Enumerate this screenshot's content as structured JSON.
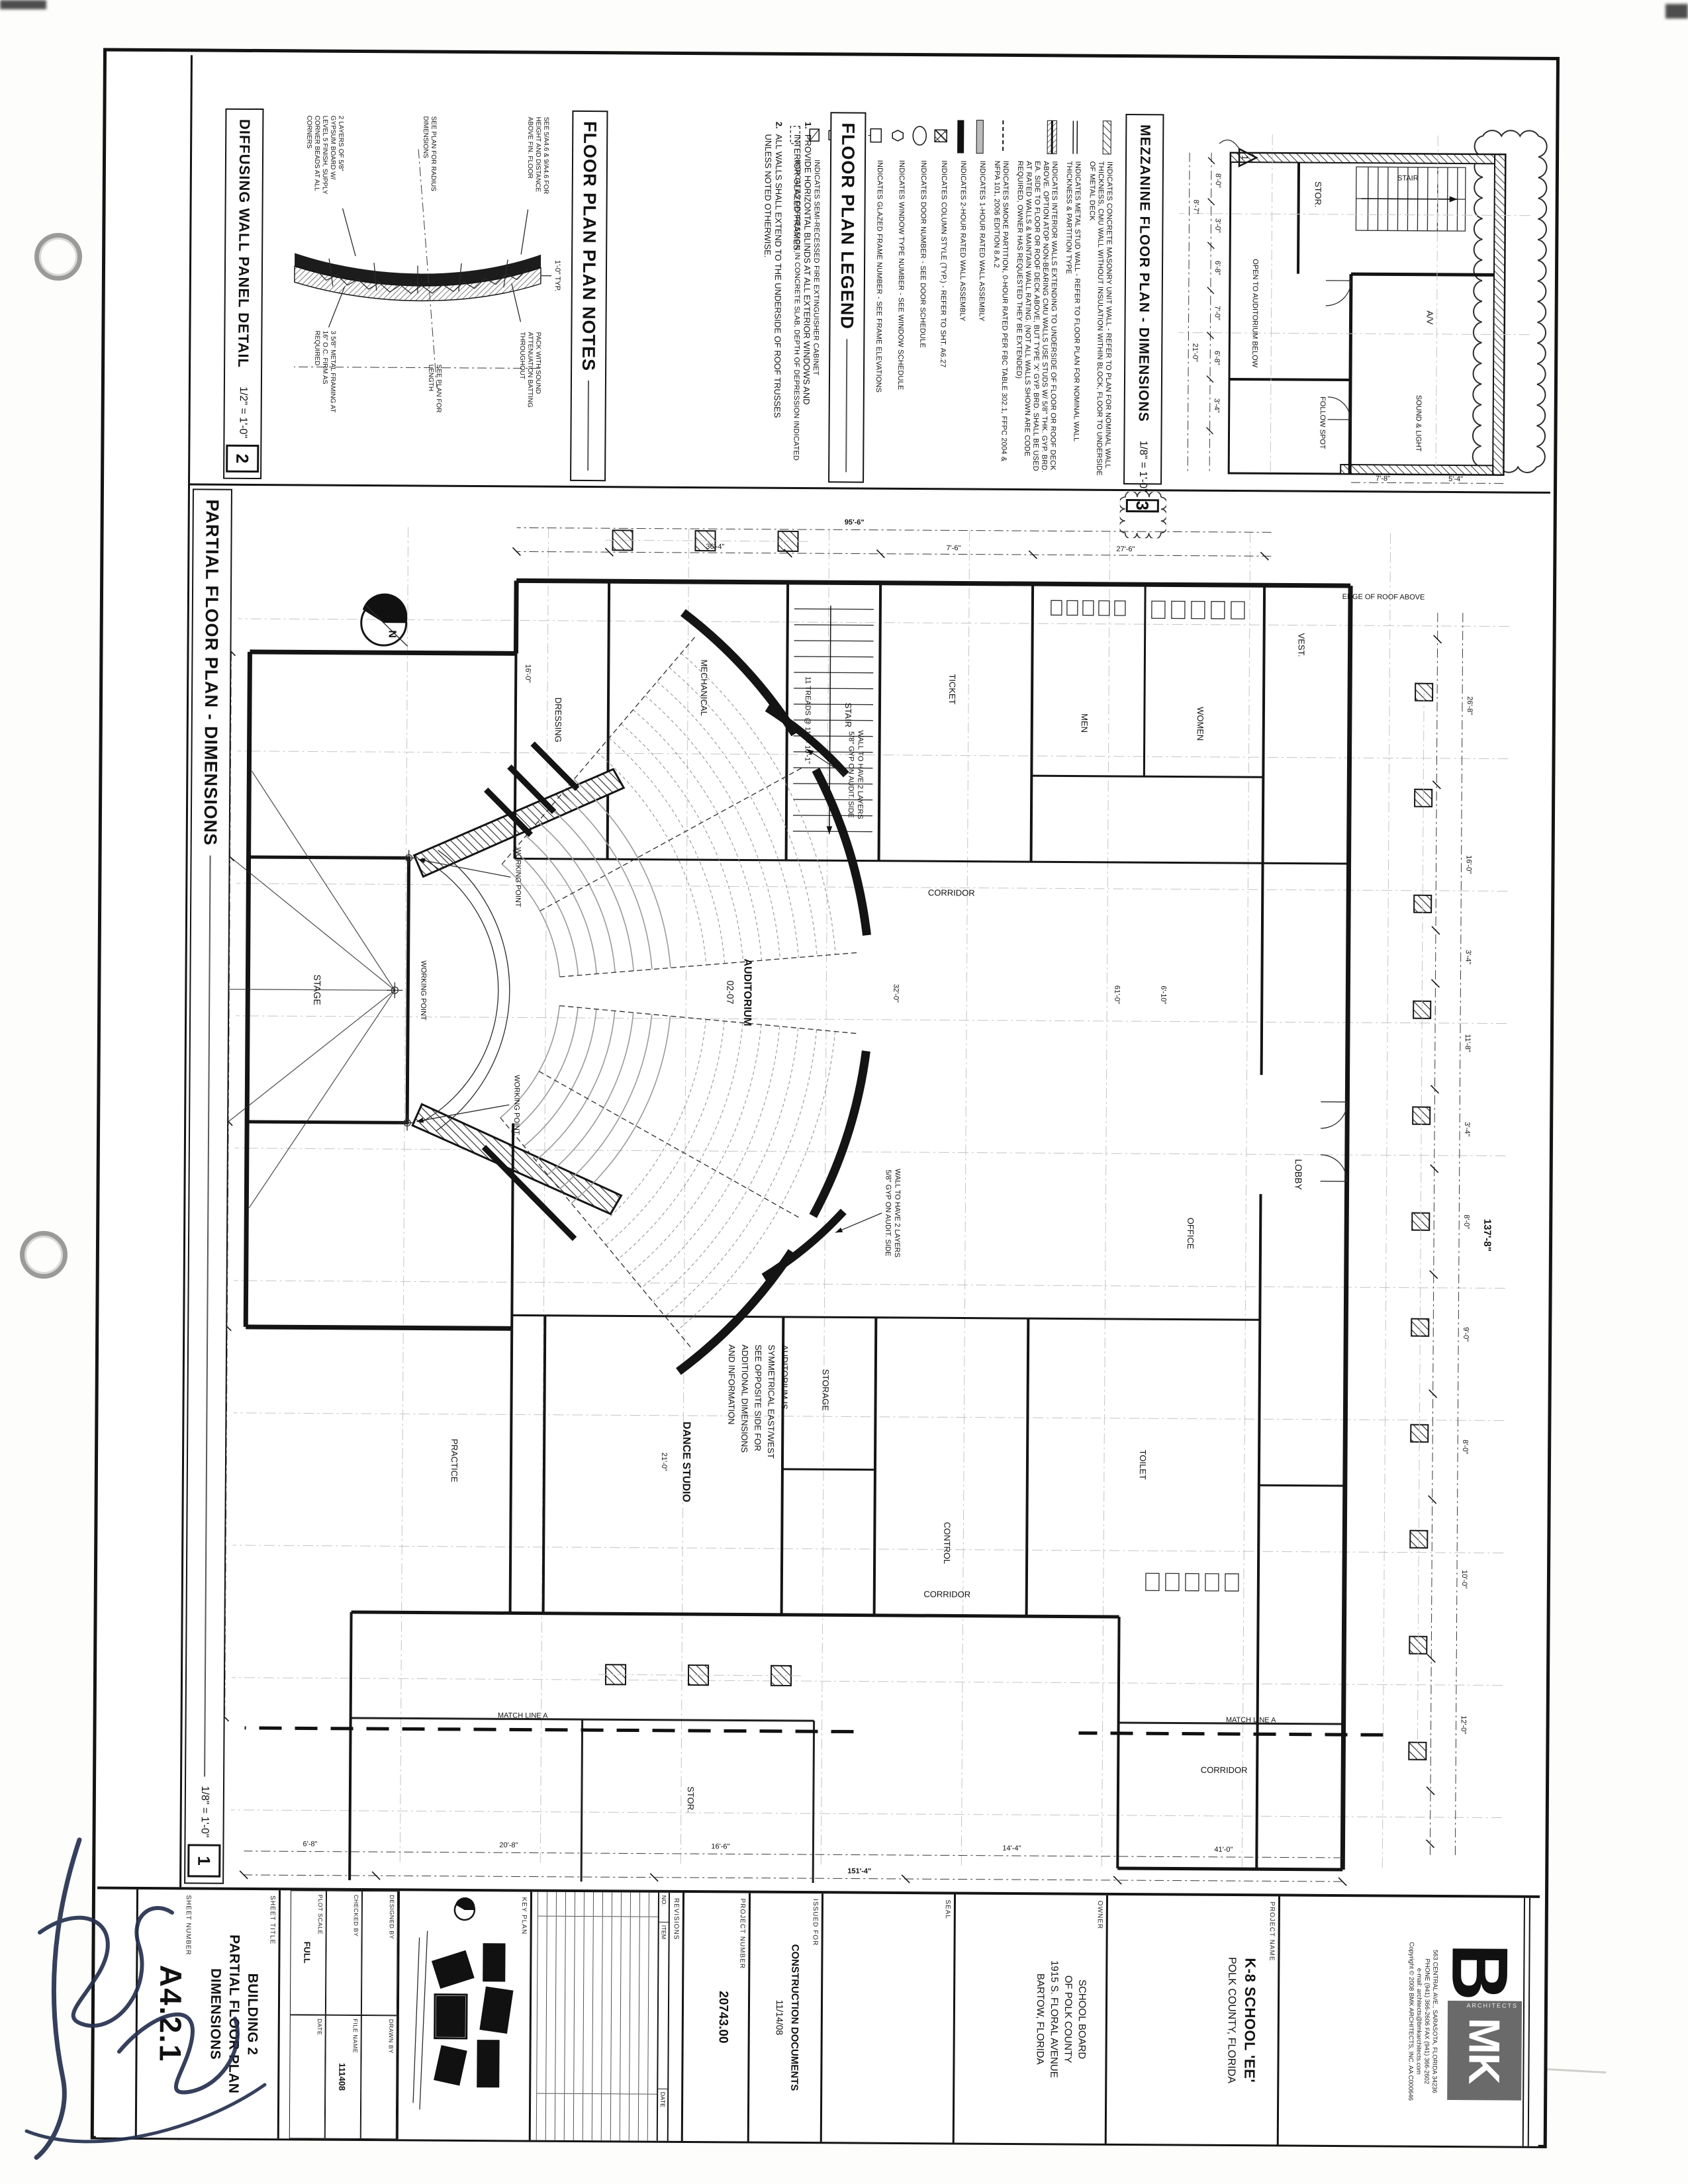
{
  "bars": {
    "plan": {
      "title": "PARTIAL FLOOR PLAN - DIMENSIONS",
      "scale": "1/8\" = 1'-0\"",
      "num": "1"
    },
    "mezz": {
      "title": "MEZZANINE FLOOR PLAN - DIMENSIONS",
      "scale": "1/8\" = 1'-0\"",
      "num": "3"
    },
    "legend": {
      "title": "FLOOR PLAN LEGEND"
    },
    "notes": {
      "title": "FLOOR PLAN PLAN NOTES"
    },
    "detail": {
      "title": "DIFFUSING WALL PANEL DETAIL",
      "scale": "1/2\" = 1'-0\"",
      "num": "2"
    }
  },
  "legend_items": [
    {
      "sym": "cmu-wall-symbol",
      "text": "INDICATES CONCRETE MASONRY UNIT WALL - REFER TO PLAN FOR NOMINAL WALL THICKNESS, CMU WALL WITHOUT INSULATION WITHIN BLOCK, FLOOR TO UNDERSIDE OF METAL DECK"
    },
    {
      "sym": "metal-stud-wall-symbol",
      "text": "INDICATES METAL STUD WALL - REFER TO FLOOR PLAN FOR NOMINAL WALL THICKNESS & PARTITION TYPE"
    },
    {
      "sym": "full-height-wall-symbol",
      "text": "INDICATES INTERIOR WALLS EXTENDING TO UNDERSIDE OF FLOOR OR ROOF DECK ABOVE. OPTION ATOP NON-BEARING CMU WALLS USE STUDS W/ 5/8\" THK. GYP. BRD. EA. SIDE TO FLOOR OR ROOF DECK ABOVE, BUT TYPE 'X' GYP. BRD. SHALL BE USED AT RATED WALLS & MAINTAIN WALL RATING. (NOT ALL WALLS SHOWN ARE CODE REQUIRED, OWNER HAS REQUESTED THEY BE EXTENDED)"
    },
    {
      "sym": "smoke-partition-symbol",
      "text": "INDICATES SMOKE PARTITION, 0-HOUR RATED PER FBC TABLE 302.1, FFPC 2004 & NFPA 101, 2006 EDITION 8.A.2"
    },
    {
      "sym": "one-hour-wall-symbol",
      "text": "INDICATES 1-HOUR RATED WALL ASSEMBLY"
    },
    {
      "sym": "two-hour-wall-symbol",
      "text": "INDICATES 2-HOUR RATED WALL ASSEMBLY"
    },
    {
      "sym": "column-symbol",
      "text": "INDICATES COLUMN STYLE (TYP.) - REFER TO SHT. A6.27"
    },
    {
      "sym": "door-number-symbol",
      "text": "INDICATES DOOR NUMBER - SEE DOOR SCHEDULE"
    },
    {
      "sym": "window-type-symbol",
      "text": "INDICATES WINDOW TYPE NUMBER - SEE WINDOW SCHEDULE"
    },
    {
      "sym": "glazed-frame-symbol",
      "text": "INDICATES GLAZED FRAME NUMBER - SEE FRAME ELEVATIONS"
    },
    {
      "sym": "partition-type-symbol",
      "text": "INDICATES MTL. STUD PARTITION TYPE - SEE SHEET A4.12"
    },
    {
      "sym": "fire-extinguisher-symbol",
      "text": "INDICATES FIRE EXTINGUISHER W/ WALL MOUNT BRACKET"
    },
    {
      "sym": "fec-symbol",
      "text": "INDICATES SEMI-RECESSED FIRE EXTINGUISHER CABINET"
    },
    {
      "sym": "slab-depression-symbol",
      "text": "INDICATES DEPRESSION IN CONCRETE SLAB, DEPTH OF DEPRESSION INDICATED"
    }
  ],
  "notes_items": [
    {
      "num": "1.",
      "text": "PROVIDE HORIZONTAL BLINDS AT ALL EXTERIOR WINDOWS AND INTERIOR GLAZED FRAMES."
    },
    {
      "num": "2.",
      "text": "ALL WALLS SHALL EXTEND TO THE UNDERSIDE OF ROOF TRUSSES UNLESS NOTED OTHERWISE."
    }
  ],
  "detail_notes": {
    "a": "SEE 5/A4.6 & 9/A4.6 FOR HEIGHT AND DISTANCE ABOVE FIN. FLOOR",
    "b": "PACK WITH SOUND ATTENUATION BATTING THROUGHOUT",
    "c": "SEE PLAN FOR RADIUS DIMENSIONS",
    "d": "SEE PLAN FOR LENGTH",
    "e": "3 5/8\" METAL FRAMING AT 16\" O.C. FIRM AS REQUIRED",
    "f": "2 LAYERS OF 5/8\" GYPSUM BOARD W/ LEVEL 5 FINISH, SUPPLY CORNER BEADS AT ALL CORNERS",
    "g": "1'-0\" TYP."
  },
  "mezz": {
    "rooms": [
      "STOR.",
      "A/V",
      "FOLLOW SPOT",
      "SOUND & LIGHT",
      "STAIR",
      "OPEN TO AUDITORIUM BELOW"
    ],
    "dims": [
      "8'-0\"",
      "3'-0\"",
      "6'-8\"",
      "7'-0\"",
      "6'-8\"",
      "3'-4\"",
      "8'-7\"",
      "21'-0\"",
      "5'-4\"",
      "7'-8\""
    ],
    "rev": "1"
  },
  "plan": {
    "rooms": {
      "auditorium": "AUDITORIUM",
      "auditorium_no": "02-07",
      "stage": "STAGE",
      "lobby": "LOBBY",
      "vest": "VEST.",
      "ticket": "TICKET",
      "stair": "STAIR",
      "mech": "MECHANICAL",
      "dressing": "DRESSING",
      "women": "WOMEN",
      "men": "MEN",
      "corridor": "CORRIDOR",
      "control": "CONTROL",
      "storage": "STORAGE",
      "stor": "STOR.",
      "dance": "DANCE STUDIO",
      "practice": "PRACTICE",
      "toilet": "TOILET",
      "office": "OFFICE"
    },
    "sym_note": [
      "AUDITORIUM IS",
      "SYMMETRICAL EAST/WEST",
      "SEE OPPOSITE SIDE FOR",
      "ADDITIONAL DIMENSIONS",
      "AND INFORMATION"
    ],
    "gyp_note": [
      "WALL TO HAVE 2 LAYERS",
      "5/8\" GYP ON AUDIT. SIDE"
    ],
    "stair_note": "11 TREADS @ 11\" = 10'-1\"",
    "roof_note": "EDGE OF ROOF ABOVE",
    "wp": "WORKING POINT",
    "match": "MATCH LINE A",
    "north": "N",
    "dims": [
      "137'-8\"",
      "26'-8\"",
      "16'-0\"",
      "3'-4\"",
      "11'-8\"",
      "3'-4\"",
      "8'-0\"",
      "9'-0\"",
      "8'-0\"",
      "10'-0\"",
      "12'-0\"",
      "151'-4\"",
      "41'-0\"",
      "14'-4\"",
      "16'-6\"",
      "20'-8\"",
      "6'-8\"",
      "95'-6\"",
      "27'-6\"",
      "7'-6\"",
      "36'-4\"",
      "61'-0\"",
      "32'-0\"",
      "48'-0\"",
      "6'-10\"",
      "21'-0\"",
      "16'-0\"",
      "5'-4\"",
      "15'-6\"",
      "3'-4\""
    ]
  },
  "tb": {
    "logo_b": "B",
    "logo_mk": "MK",
    "logo_sub": "ARCHITECTS",
    "addr": [
      "563 CENTRAL AVE., SARASOTA, FLORIDA 34236",
      "PHONE (941) 366-2606   FAX (941) 366-2602",
      "e-mail: architects@bmkarchitects.com",
      "Copyright © 2008 BMK ARCHITECTS, INC.  AA C000646"
    ],
    "labels": {
      "project_name": "PROJECT NAME",
      "owner": "OWNER",
      "seal": "SEAL",
      "issued_for": "ISSUED FOR",
      "project_number": "PROJECT NUMBER",
      "revisions": "REVISIONS",
      "no": "NO.",
      "item": "ITEM",
      "date": "DATE",
      "key_plan": "KEY PLAN",
      "designed_by": "DESIGNED BY",
      "drawn_by": "DRAWN BY",
      "checked_by": "CHECKED BY",
      "file_name": "FILE NAME",
      "plot_scale": "PLOT SCALE",
      "date2": "DATE",
      "sheet_title": "SHEET TITLE",
      "sheet_number": "SHEET NUMBER"
    },
    "project_name_1": "K-8 SCHOOL 'EE'",
    "project_name_2": "POLK COUNTY, FLORIDA",
    "owner_lines": [
      "SCHOOL BOARD",
      "OF POLK COUNTY",
      "1915 S. FLORAL AVENUE",
      "BARTOW, FLORIDA"
    ],
    "issued": "CONSTRUCTION DOCUMENTS",
    "issued_date": "11/14/08",
    "project_number": "20743.00",
    "file_name": "111408",
    "plot_scale": "FULL",
    "sheet_title_lines": [
      "BUILDING 2",
      "PARTIAL FLOOR PLAN",
      "DIMENSIONS"
    ],
    "sheet_number": "A4.2.1"
  }
}
